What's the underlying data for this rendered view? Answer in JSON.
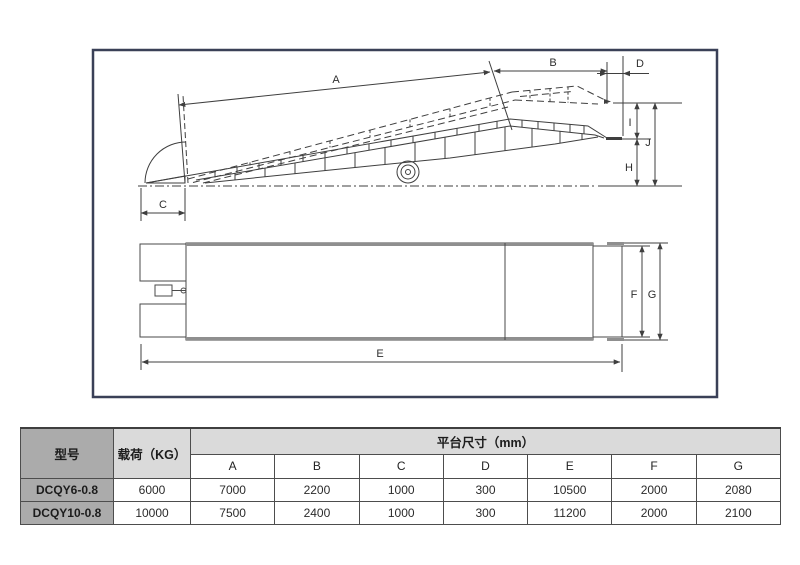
{
  "diagram": {
    "labels": {
      "a": "A",
      "b": "B",
      "c": "C",
      "d": "D",
      "e": "E",
      "f": "F",
      "g": "G",
      "h": "H",
      "i": "I",
      "j": "J"
    }
  },
  "table": {
    "col_model": "型号",
    "col_load": "载荷（KG）",
    "col_platform": "平台尺寸（mm）",
    "dim_headers": [
      "A",
      "B",
      "C",
      "D",
      "E",
      "F",
      "G"
    ],
    "rows": [
      {
        "model": "DCQY6-0.8",
        "load": "6000",
        "dims": [
          "7000",
          "2200",
          "1000",
          "300",
          "10500",
          "2000",
          "2080"
        ]
      },
      {
        "model": "DCQY10-0.8",
        "load": "10000",
        "dims": [
          "7500",
          "2400",
          "1000",
          "300",
          "11200",
          "2000",
          "2100"
        ]
      }
    ]
  },
  "colors": {
    "frame_border": "#3a4057",
    "drawing_line": "#3f3f3f",
    "thick_edge_grey": "#8f8f8f",
    "table_dark_cell": "#ababab",
    "table_light_cell": "#dadada",
    "table_border": "#4d4d4d"
  }
}
